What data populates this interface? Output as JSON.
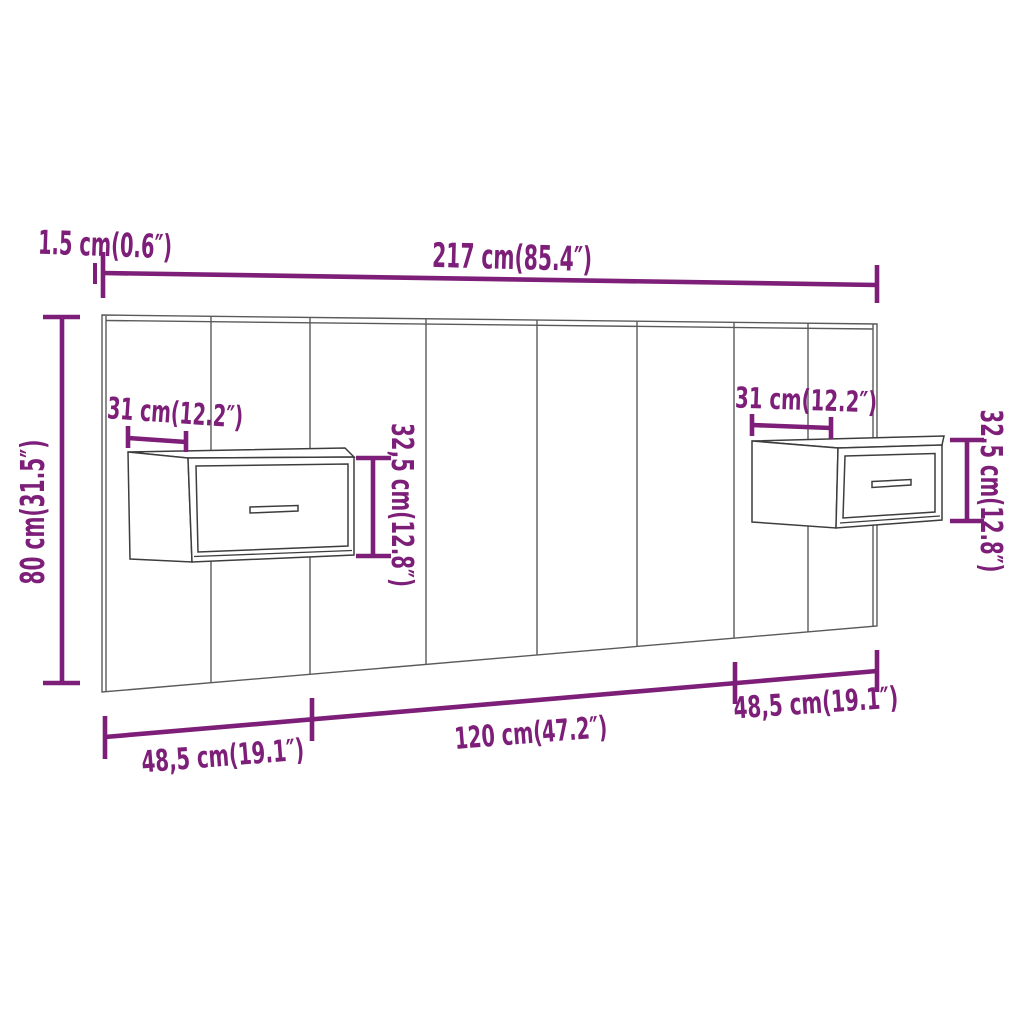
{
  "diagram": {
    "type": "furniture-dimension-diagram",
    "background_color": "#ffffff",
    "colors": {
      "dimension_annotations": "#7D1E78",
      "headboard_lines": "#5a5a5a",
      "cabinet_lines": "#3d3d3d"
    },
    "headboard": {
      "panel_count": 8,
      "cabinet_count": 2
    },
    "dimensions": {
      "thickness": "1.5 cm(0.6″)",
      "total_width": "217 cm(85.4″)",
      "total_height": "80 cm(31.5″)",
      "cabinet_left_width": "31 cm(12.2″)",
      "cabinet_left_height": "32,5 cm(12.8″)",
      "cabinet_right_width": "31 cm(12.2″)",
      "cabinet_right_height": "32,5 cm(12.8″)",
      "bottom_left_segment": "48,5 cm(19.1″)",
      "bottom_center_segment": "120 cm(47.2″)",
      "bottom_right_segment": "48,5 cm(19.1″)"
    }
  }
}
